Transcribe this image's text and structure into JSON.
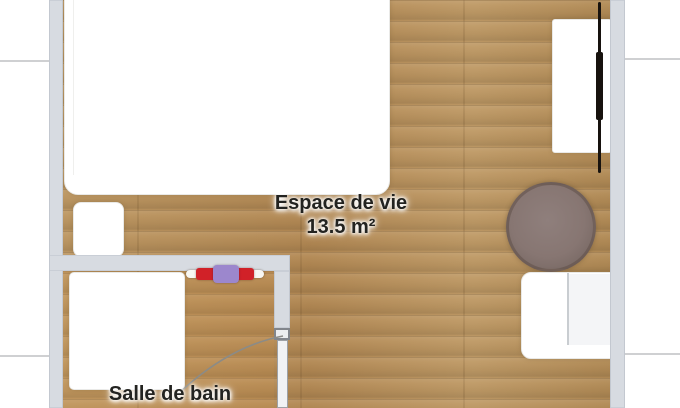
{
  "plan": {
    "type": "apartment-floor-plan",
    "rooms": [
      {
        "id": "living",
        "name": "Espace de vie",
        "area": "13.5 m²"
      },
      {
        "id": "bathroom",
        "name": "Salle de bain",
        "area": ""
      }
    ],
    "furniture": [
      "bed",
      "nightstand",
      "tv",
      "tv-console",
      "round-rug",
      "kitchenette-unit",
      "shower",
      "towel-radiator",
      "bathroom-door"
    ],
    "colors": {
      "floor_wood": "#b79159",
      "floor_wood_dark": "#a8854f",
      "wall": "#d7dbe1",
      "exterior": "#ffffff",
      "rug": "#857470",
      "radiator_red": "#d12128",
      "radiator_purple": "#9c87cd",
      "door_arc": "#8b8b87",
      "tv": "#17120e",
      "label_text": "#232320"
    }
  }
}
